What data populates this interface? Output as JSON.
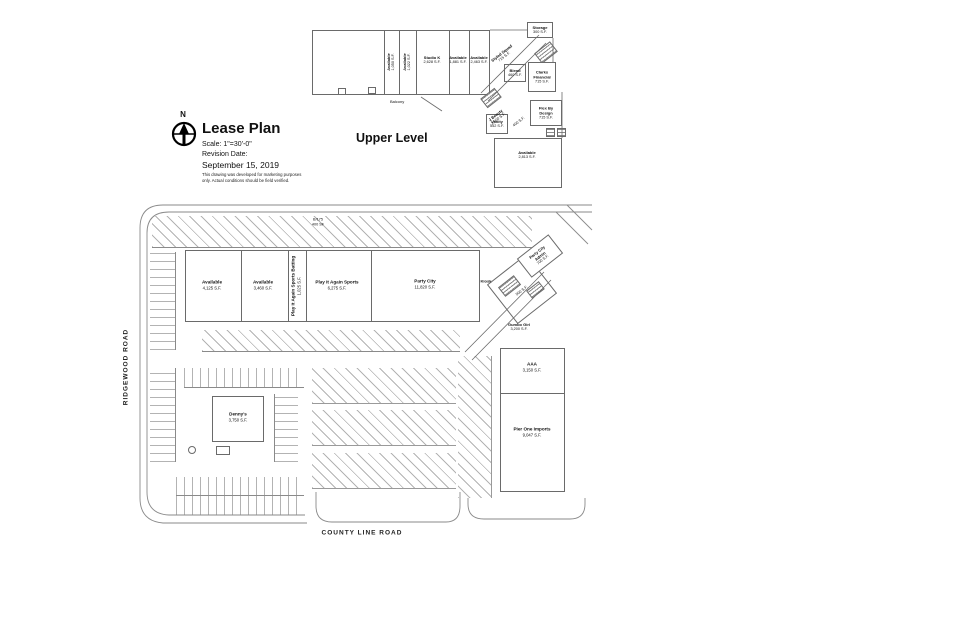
{
  "title_block": {
    "north": "N",
    "title": "Lease Plan",
    "scale": "Scale: 1\"=30'-0\"",
    "revision_label": "Revision Date:",
    "revision_date": "September 15, 2019",
    "disclaimer_line1": "This drawing was developed for marketing purposes",
    "disclaimer_line2": "only. Actual conditions should be field verified."
  },
  "upper_level": {
    "heading": "Upper Level",
    "balcony": "Balcony",
    "strip_units": [
      {
        "name": "Available",
        "size": "1,050 S.F."
      },
      {
        "name": "Available",
        "size": "1,022 S.F."
      },
      {
        "name": "Studio K",
        "size": "2,628 S.F."
      },
      {
        "name": "Available",
        "size": "1,881 S.F."
      },
      {
        "name": "Available",
        "size": "2,463 S.F."
      }
    ],
    "cluster_units": [
      {
        "name": "Storage",
        "size": "300 S.F."
      },
      {
        "name": "Styled Squad",
        "size": "715 S.F."
      },
      {
        "name": "Blend",
        "size": "460 S.F."
      },
      {
        "name": "Clarks Financial",
        "size": "715 S.F."
      },
      {
        "name": "J Beauty",
        "size": "1,000 S.F."
      },
      {
        "name": "Flex By Design",
        "size": "715 S.F."
      },
      {
        "name": "Vanity",
        "size": "552 S.F."
      },
      {
        "name": "",
        "size": "400 S.F."
      },
      {
        "name": "Available",
        "size": "2,813 S.F."
      }
    ]
  },
  "site_plan": {
    "road_left": "RIDGEWOOD ROAD",
    "road_bottom": "COUNTY LINE ROAD",
    "note_line1": "B/175",
    "note_line2": "400 SF",
    "main_units": [
      {
        "name": "Available",
        "size": "4,125 S.F."
      },
      {
        "name": "Available",
        "size": "3,460 S.F."
      },
      {
        "name": "Play It Again Sports Batting",
        "size": "1,025 S.F."
      },
      {
        "name": "Play It Again Sports",
        "size": "6,275 S.F."
      },
      {
        "name": "Party City",
        "size": "11,820 S.F."
      }
    ],
    "corner_units": [
      {
        "name": "Party City Admin",
        "size": "700 S.F."
      },
      {
        "name": "Kiosk",
        "size": ""
      },
      {
        "name": "",
        "size": "500 S.F."
      },
      {
        "name": "Gumbo Girl",
        "size": "3,200 S.F."
      }
    ],
    "east_units": [
      {
        "name": "AAA",
        "size": "3,150 S.F."
      },
      {
        "name": "Pier One Imports",
        "size": "9,047 S.F."
      }
    ],
    "outparcel": {
      "name": "Denny's",
      "size": "3,750 S.F."
    }
  }
}
